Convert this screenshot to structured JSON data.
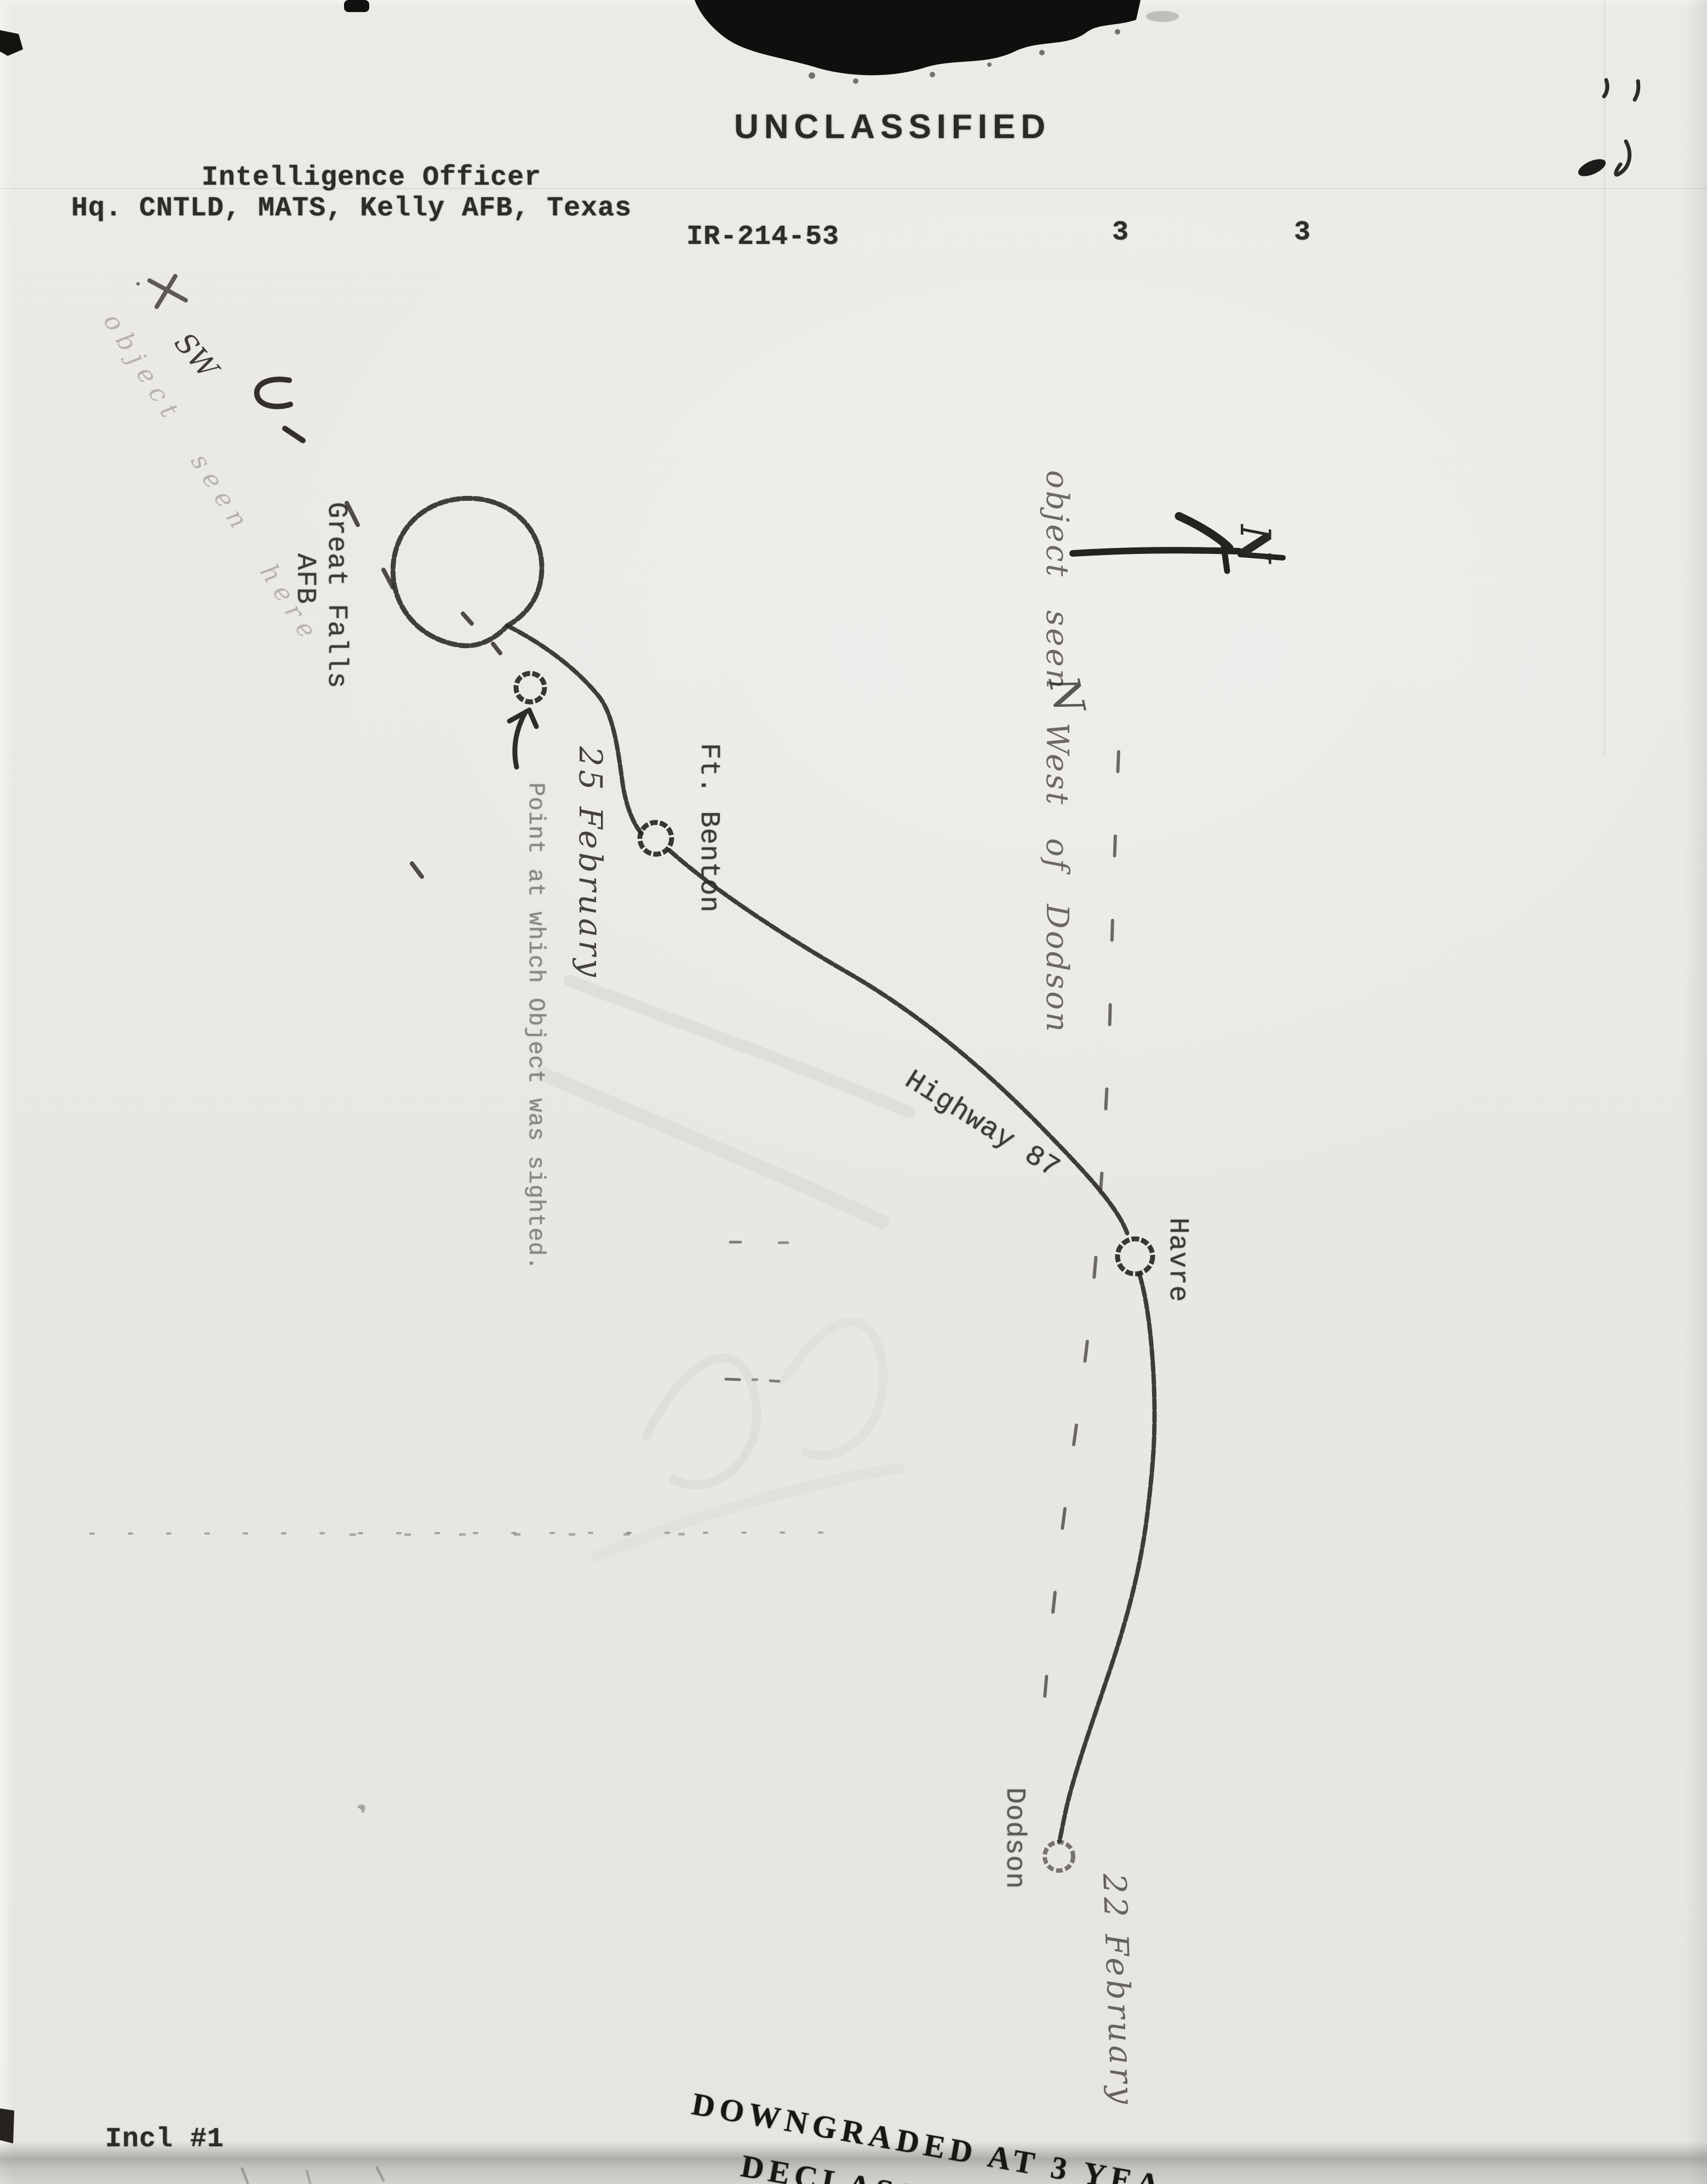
{
  "document": {
    "classification": "UNCLASSIFIED",
    "header": {
      "line1": "Intelligence Officer",
      "line2": "Hq. CNTLD, MATS, Kelly AFB, Texas"
    },
    "report_id": "IR-214-53",
    "page_numbers": [
      "3",
      "3"
    ],
    "enclosure": "Incl #1",
    "stamp": {
      "line1": "DOWNGRADED AT 3 YEA",
      "line2": "DECLASSIFIED"
    }
  },
  "map": {
    "places": {
      "great_falls_line1": "Great Falls",
      "great_falls_line2": "AFB",
      "ft_benton": "Ft. Benton",
      "havre": "Havre",
      "dodson": "Dodson"
    },
    "roads": {
      "highway": "Highway 87"
    },
    "notes": {
      "sighting_caption": "Point at which Object was sighted.",
      "date_sighting": "25 February",
      "date_dodson": "22 February",
      "route_note": "object seen West of Dodson",
      "origin_note": "object seen here",
      "direction": "SW",
      "north": "N",
      "north_small": "N"
    }
  },
  "colors": {
    "paper": "#e9e8e4",
    "ink": "#272521",
    "pencil": "#55524b"
  }
}
